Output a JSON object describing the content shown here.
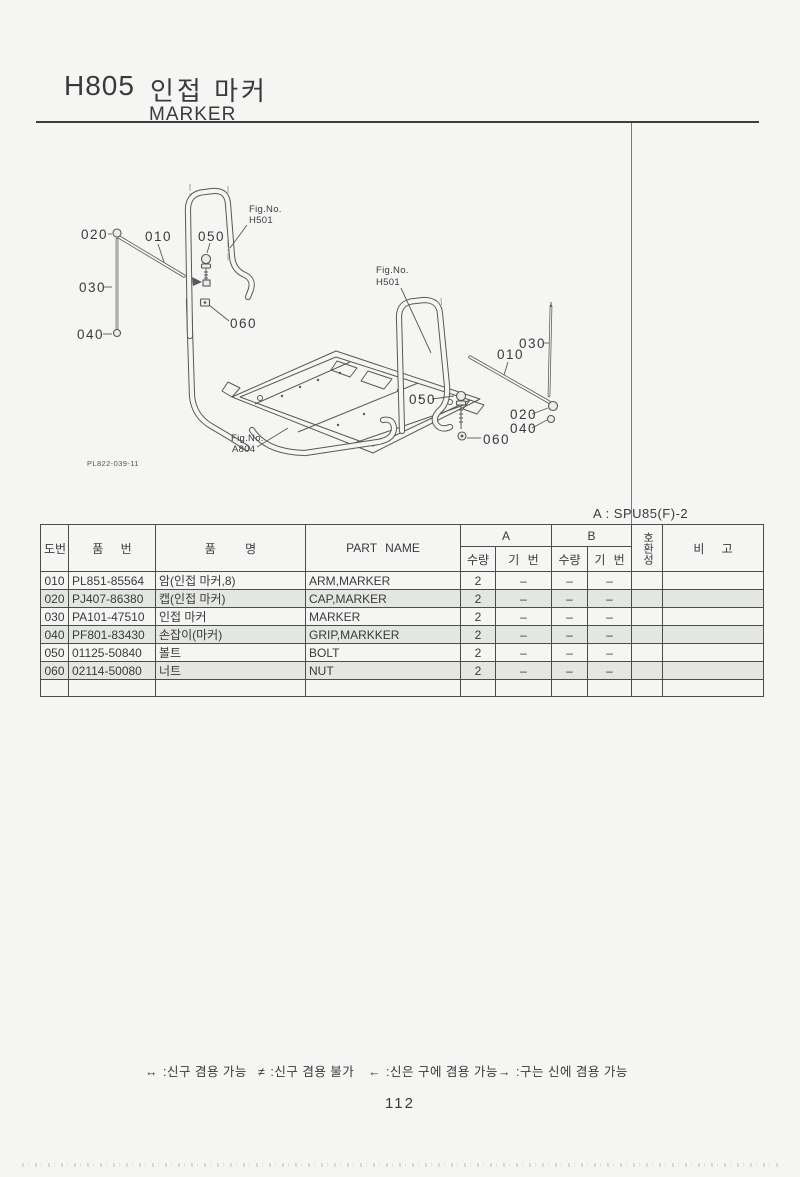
{
  "page": {
    "code": "H805",
    "title_ko": "인접 마커",
    "title_en": "MARKER",
    "variant_note": "A : SPU85(F)-2",
    "page_number": "112"
  },
  "diagram": {
    "drawing_number": "PL822-039-11",
    "left": {
      "c010": "010",
      "c020": "020",
      "c030": "030",
      "c040": "040",
      "c050": "050",
      "c060": "060",
      "fig_label": "Fig.No.",
      "fig_no": "H501"
    },
    "right": {
      "c010": "010",
      "c020": "020",
      "c030": "030",
      "c040": "040",
      "c050": "050",
      "c060": "060",
      "fig_label": "Fig.No.",
      "fig_no": "H501"
    },
    "frame": {
      "fig_label": "Fig.No.",
      "fig_no": "A804"
    }
  },
  "table": {
    "col_no": "도번",
    "col_part_no": "품 번",
    "col_name_ko": "품 명",
    "col_part_name": "PART NAME",
    "group_a": "A",
    "group_b": "B",
    "col_qty_a": "수량",
    "col_serial_a": "기 번",
    "col_qty_b": "수량",
    "col_serial_b": "기 번",
    "col_compat": "호환성",
    "col_remark": "비 고",
    "rows": [
      {
        "no": "010",
        "part_no": "PL851-85564",
        "name_ko": "암(인접 마커,8)",
        "name_en": "ARM,MARKER",
        "a_qty": "2",
        "a_serial": "–",
        "b_qty": "–",
        "b_serial": "–",
        "compat": "",
        "remark": ""
      },
      {
        "no": "020",
        "part_no": "PJ407-86380",
        "name_ko": "캡(인접 마커)",
        "name_en": "CAP,MARKER",
        "a_qty": "2",
        "a_serial": "–",
        "b_qty": "–",
        "b_serial": "–",
        "compat": "",
        "remark": ""
      },
      {
        "no": "030",
        "part_no": "PA101-47510",
        "name_ko": "인접 마커",
        "name_en": "MARKER",
        "a_qty": "2",
        "a_serial": "–",
        "b_qty": "–",
        "b_serial": "–",
        "compat": "",
        "remark": ""
      },
      {
        "no": "040",
        "part_no": "PF801-83430",
        "name_ko": "손잡이(마커)",
        "name_en": "GRIP,MARKKER",
        "a_qty": "2",
        "a_serial": "–",
        "b_qty": "–",
        "b_serial": "–",
        "compat": "",
        "remark": ""
      },
      {
        "no": "050",
        "part_no": "01125-50840",
        "name_ko": "볼트",
        "name_en": "BOLT",
        "a_qty": "2",
        "a_serial": "–",
        "b_qty": "–",
        "b_serial": "–",
        "compat": "",
        "remark": ""
      },
      {
        "no": "060",
        "part_no": "02114-50080",
        "name_ko": "너트",
        "name_en": "NUT",
        "a_qty": "2",
        "a_serial": "–",
        "b_qty": "–",
        "b_serial": "–",
        "compat": "",
        "remark": ""
      }
    ]
  },
  "legend": {
    "items": [
      {
        "symbol": "↔",
        "text": ":신구 겸용 가능"
      },
      {
        "symbol": "≠",
        "text": ":신구 겸용 불가"
      },
      {
        "symbol": "←",
        "text": ":신은 구에 겸용 가능"
      },
      {
        "symbol": "→",
        "text": ":구는 신에 겸용 가능"
      }
    ]
  }
}
